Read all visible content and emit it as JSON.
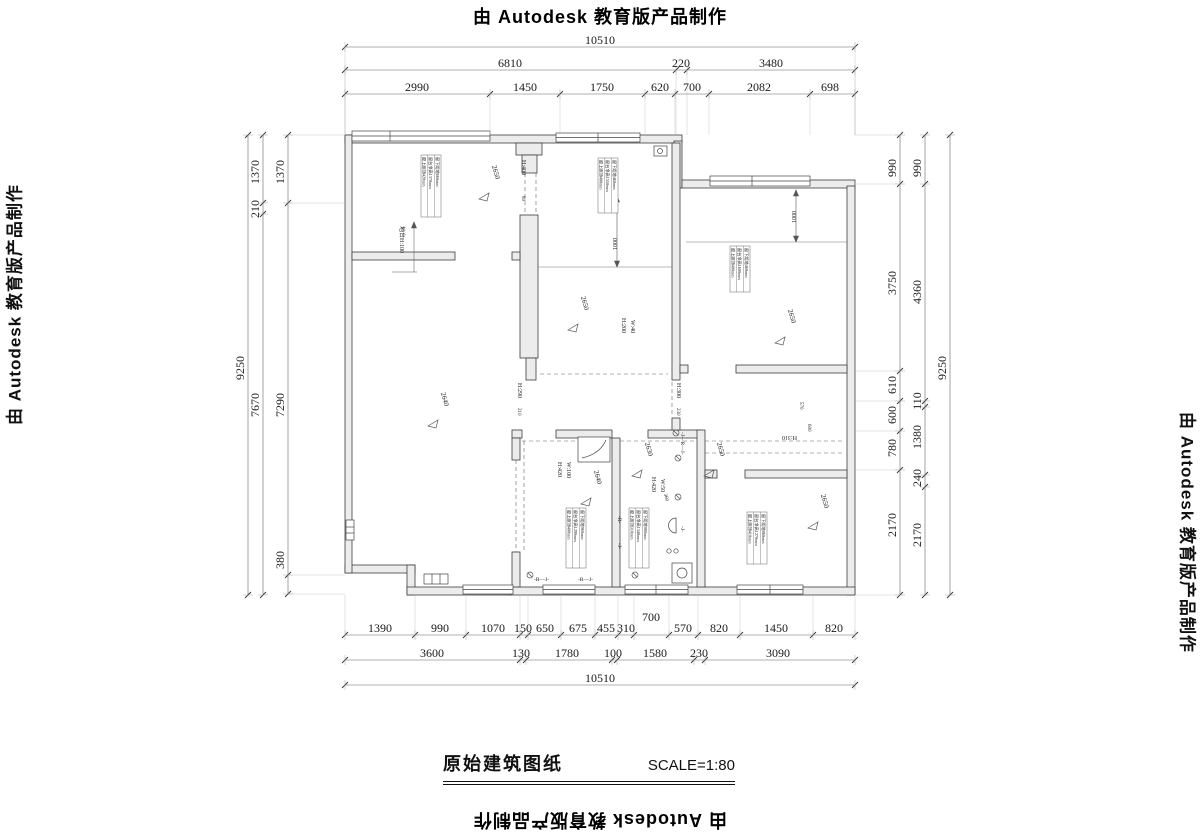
{
  "frame": {
    "top_credit": "由 Autodesk 教育版产品制作",
    "bottom_credit": "由 Autodesk 教育版产品制作",
    "left_credit": "由 Autodesk 教育版产品制作",
    "right_credit": "由 Autodesk 教育版产品制作"
  },
  "title": {
    "name": "原始建筑图纸",
    "scale": "SCALE=1:80"
  },
  "dims": [
    {
      "o": "h",
      "y": 47,
      "x1": 345,
      "x2": 855,
      "e": 135,
      "ticks": [
        345,
        855
      ],
      "labels": [
        {
          "t": "10510",
          "p": 600
        }
      ]
    },
    {
      "o": "h",
      "y": 70,
      "x1": 345,
      "x2": 855,
      "e": 135,
      "ticks": [
        345,
        676,
        687,
        855
      ],
      "labels": [
        {
          "t": "6810",
          "p": 510
        },
        {
          "t": "220",
          "p": 681
        },
        {
          "t": "3480",
          "p": 771
        }
      ]
    },
    {
      "o": "h",
      "y": 94,
      "x1": 345,
      "x2": 855,
      "e": 135,
      "ticks": [
        345,
        490,
        560,
        645,
        675,
        709,
        810,
        855
      ],
      "labels": [
        {
          "t": "2990",
          "p": 417
        },
        {
          "t": "1450",
          "p": 525
        },
        {
          "t": "1750",
          "p": 602
        },
        {
          "t": "620",
          "p": 660
        },
        {
          "t": "700",
          "p": 692
        },
        {
          "t": "2082",
          "p": 759
        },
        {
          "t": "698",
          "p": 830
        }
      ]
    },
    {
      "o": "h",
      "y": 635,
      "x1": 345,
      "x2": 855,
      "e": 595,
      "ticks": [
        345,
        415,
        466,
        520,
        528,
        561,
        595,
        618,
        634,
        669,
        698,
        740,
        813,
        855
      ],
      "labels": [
        {
          "t": "1390",
          "p": 380
        },
        {
          "t": "990",
          "p": 440
        },
        {
          "t": "1070",
          "p": 493
        },
        {
          "t": "150",
          "p": 523
        },
        {
          "t": "650",
          "p": 545
        },
        {
          "t": "675",
          "p": 578
        },
        {
          "t": "455",
          "p": 606
        },
        {
          "t": "310",
          "p": 626
        },
        {
          "t": "700",
          "p": 651,
          "dy": -11
        },
        {
          "t": "570",
          "p": 683
        },
        {
          "t": "820",
          "p": 719
        },
        {
          "t": "1450",
          "p": 776
        },
        {
          "t": "820",
          "p": 834
        }
      ]
    },
    {
      "o": "h",
      "y": 660,
      "x1": 345,
      "x2": 855,
      "ticks": [
        345,
        520,
        526,
        612,
        617,
        694,
        705,
        855
      ],
      "labels": [
        {
          "t": "3600",
          "p": 432
        },
        {
          "t": "130",
          "p": 521
        },
        {
          "t": "1780",
          "p": 567
        },
        {
          "t": "100",
          "p": 613
        },
        {
          "t": "1580",
          "p": 655
        },
        {
          "t": "230",
          "p": 699
        },
        {
          "t": "3090",
          "p": 778
        }
      ]
    },
    {
      "o": "h",
      "y": 685,
      "x1": 345,
      "x2": 855,
      "ticks": [
        345,
        855
      ],
      "labels": [
        {
          "t": "10510",
          "p": 600
        }
      ]
    },
    {
      "o": "v",
      "x": 248,
      "y1": 135,
      "y2": 595,
      "ticks": [
        135,
        595
      ],
      "labels": [
        {
          "t": "9250",
          "p": 368
        }
      ]
    },
    {
      "o": "v",
      "x": 263,
      "y1": 135,
      "y2": 595,
      "ticks": [
        135,
        203,
        214,
        595
      ],
      "labels": [
        {
          "t": "1370",
          "p": 172
        },
        {
          "t": "210",
          "p": 209
        },
        {
          "t": "7670",
          "p": 405
        }
      ]
    },
    {
      "o": "v",
      "x": 288,
      "y1": 135,
      "y2": 595,
      "e": 345,
      "ticks": [
        135,
        203,
        575,
        594
      ],
      "labels": [
        {
          "t": "1370",
          "p": 172
        },
        {
          "t": "7290",
          "p": 405
        },
        {
          "t": "380",
          "p": 560
        }
      ]
    },
    {
      "o": "v",
      "x": 900,
      "y1": 135,
      "y2": 595,
      "e": 855,
      "ticks": [
        135,
        184,
        371,
        401,
        431,
        470,
        595
      ],
      "labels": [
        {
          "t": "990",
          "p": 168
        },
        {
          "t": "3750",
          "p": 283
        },
        {
          "t": "610",
          "p": 385
        },
        {
          "t": "600",
          "p": 415
        },
        {
          "t": "780",
          "p": 448
        },
        {
          "t": "2170",
          "p": 525
        }
      ]
    },
    {
      "o": "v",
      "x": 925,
      "y1": 135,
      "y2": 595,
      "ticks": [
        135,
        184,
        401,
        407,
        475,
        487,
        595
      ],
      "labels": [
        {
          "t": "990",
          "p": 168
        },
        {
          "t": "4360",
          "p": 292
        },
        {
          "t": "110",
          "p": 401
        },
        {
          "t": "1380",
          "p": 437
        },
        {
          "t": "240",
          "p": 478
        },
        {
          "t": "2170",
          "p": 535
        }
      ]
    },
    {
      "o": "v",
      "x": 950,
      "y1": 135,
      "y2": 595,
      "ticks": [
        135,
        595
      ],
      "labels": [
        {
          "t": "9250",
          "p": 368
        }
      ]
    }
  ],
  "plan": {
    "labels": [
      {
        "t": "H:400",
        "x": 522,
        "y": 160,
        "r": 90,
        "s": 6
      },
      {
        "t": "80",
        "x": 522,
        "y": 196,
        "r": 90,
        "s": 5
      },
      {
        "t": "H:200",
        "x": 622,
        "y": 318,
        "r": 90,
        "s": 6
      },
      {
        "t": "W:40",
        "x": 631,
        "y": 320,
        "r": 90,
        "s": 6
      },
      {
        "t": "H:290",
        "x": 518,
        "y": 383,
        "r": 90,
        "s": 6
      },
      {
        "t": "210",
        "x": 518,
        "y": 408,
        "r": 90,
        "s": 5
      },
      {
        "t": "H:300",
        "x": 677,
        "y": 383,
        "r": 90,
        "s": 6
      },
      {
        "t": "230",
        "x": 677,
        "y": 408,
        "r": 90,
        "s": 5
      },
      {
        "t": "H:310",
        "x": 797,
        "y": 436,
        "r": 180,
        "s": 6
      },
      {
        "t": "570",
        "x": 800,
        "y": 402,
        "r": 90,
        "s": 5
      },
      {
        "t": "600",
        "x": 808,
        "y": 424,
        "r": 90,
        "s": 5
      },
      {
        "t": "H:420",
        "x": 558,
        "y": 462,
        "r": 90,
        "s": 6
      },
      {
        "t": "W:100",
        "x": 567,
        "y": 462,
        "r": 90,
        "s": 6
      },
      {
        "t": "H:420",
        "x": 652,
        "y": 477,
        "r": 90,
        "s": 6
      },
      {
        "t": "W:50",
        "x": 661,
        "y": 479,
        "r": 90,
        "s": 6
      },
      {
        "t": "地台H:100",
        "x": 400,
        "y": 226,
        "r": 90,
        "s": 6
      },
      {
        "t": "1000",
        "x": 617,
        "y": 244,
        "r": -90,
        "s": 6,
        "a": "middle"
      },
      {
        "t": "1000",
        "x": 796,
        "y": 217,
        "r": -90,
        "s": 6,
        "a": "middle"
      },
      {
        "t": "360",
        "x": 664,
        "y": 494,
        "r": 75,
        "s": 5
      },
      {
        "t": "-R—J-",
        "x": 534,
        "y": 581,
        "r": 0,
        "s": 5.5
      },
      {
        "t": "-R—J-",
        "x": 578,
        "y": 581,
        "r": 0,
        "s": 5.5
      },
      {
        "t": "-J—R—J-",
        "x": 681,
        "y": 432,
        "r": 90,
        "s": 5.5
      },
      {
        "t": "-J-",
        "x": 681,
        "y": 526,
        "r": 90,
        "s": 5.5
      },
      {
        "t": "-R-",
        "x": 618,
        "y": 516,
        "r": 90,
        "s": 5.5
      },
      {
        "t": "-J-",
        "x": 618,
        "y": 543,
        "r": 90,
        "s": 5.5
      }
    ],
    "levels": [
      {
        "t": "2650",
        "x": 492,
        "y": 166
      },
      {
        "t": "2650",
        "x": 581,
        "y": 297
      },
      {
        "t": "2650",
        "x": 788,
        "y": 310
      },
      {
        "t": "2650",
        "x": 717,
        "y": 443
      },
      {
        "t": "2650",
        "x": 821,
        "y": 495
      },
      {
        "t": "2640",
        "x": 441,
        "y": 393
      },
      {
        "t": "2640",
        "x": 594,
        "y": 471
      },
      {
        "t": "2630",
        "x": 645,
        "y": 443
      }
    ],
    "blocks": [
      {
        "x": 421,
        "y": 155,
        "h": 62,
        "lines": [
          "窗上距顶420mm",
          "窗台净高1370mm",
          "窗下距地660mm"
        ]
      },
      {
        "x": 598,
        "y": 158,
        "h": 55,
        "lines": [
          "窗上距顶400mm",
          "窗台净高1550mm",
          "窗下距地460mm"
        ]
      },
      {
        "x": 730,
        "y": 246,
        "h": 46,
        "lines": [
          "窗上距顶400mm",
          "窗台净高1600mm",
          "窗下距地460mm"
        ]
      },
      {
        "x": 566,
        "y": 508,
        "h": 60,
        "lines": [
          "窗上距顶400mm",
          "窗台净高1290mm",
          "窗下距地960mm"
        ]
      },
      {
        "x": 629,
        "y": 508,
        "h": 60,
        "lines": [
          "窗上距顶310mm",
          "窗台净高1340mm",
          "窗下距地980mm"
        ]
      },
      {
        "x": 747,
        "y": 512,
        "h": 52,
        "lines": [
          "窗上距顶410mm",
          "窗台净高1270mm",
          "窗下距地860mm"
        ]
      }
    ]
  }
}
